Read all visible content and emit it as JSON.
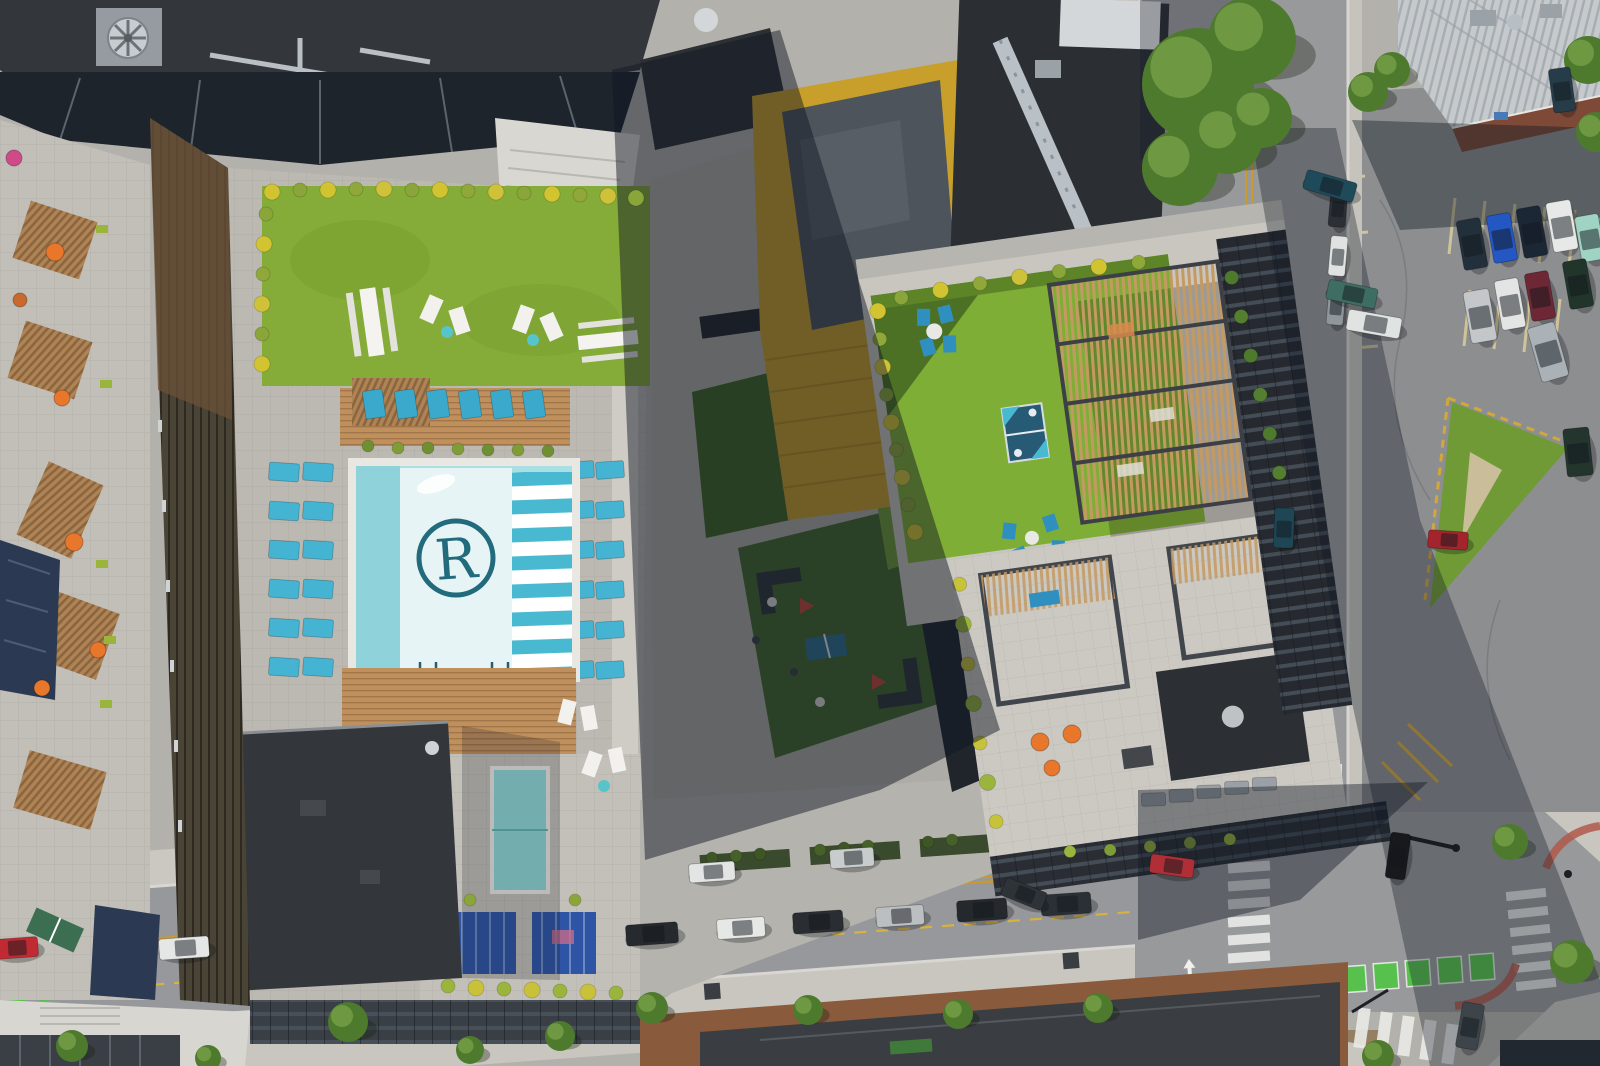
{
  "scene": {
    "description": "Aerial drone view of apartment rooftops with pool, lawns, pergola, streets, intersection and parking lot",
    "logo": {
      "letter": "R"
    },
    "palette": {
      "asphalt": "#98999b",
      "asphalt_dark": "#8d8e90",
      "concrete": "#c9c6bf",
      "deck_paver": "#bcb9b2",
      "lawn": "#85ab38",
      "lawn_shade": "#4c7124",
      "lawn_dark": "#44692b",
      "pool_water": "#aadfe4",
      "pool_edge": "#8fd2da",
      "pool_panel": "#e6f4f5",
      "pool_stripe": "#49b9d2",
      "logo_teal": "#216b7d",
      "lounger_teal": "#45b4d2",
      "wood": "#c0905c",
      "cabana_blue": "#2e55a5",
      "yellow_tower": "#c79f2a",
      "metal_roof": "#c6cacd",
      "brick": "#8a5a3c",
      "roof_dark": "#33373c",
      "facade_dark": "#2a2f36",
      "road_yellow": "#c99a2e",
      "road_green": "#58c14e",
      "curb_red": "#b0584a",
      "orange": "#e8762b",
      "tree_green": "#4e7a2e",
      "hot_tub": "#8fd8d4"
    },
    "cars": [
      [
        652,
        934,
        52,
        21,
        -4,
        "#26292d"
      ],
      [
        741,
        928,
        48,
        20,
        -4,
        "#e6e8e6"
      ],
      [
        818,
        922,
        50,
        21,
        -4,
        "#2a2d31"
      ],
      [
        900,
        916,
        48,
        20,
        -4,
        "#bcbfc2"
      ],
      [
        982,
        910,
        50,
        21,
        -4,
        "#25282c"
      ],
      [
        1066,
        904,
        50,
        21,
        -4,
        "#2b3036"
      ],
      [
        712,
        872,
        46,
        19,
        -4,
        "#e2e5e4"
      ],
      [
        852,
        858,
        44,
        19,
        -4,
        "#c9cccd"
      ],
      [
        1024,
        894,
        44,
        19,
        22,
        "#2e3338"
      ],
      [
        1172,
        866,
        44,
        19,
        8,
        "#b02f36"
      ],
      [
        16,
        948,
        44,
        20,
        -4,
        "#c22a33"
      ],
      [
        184,
        948,
        50,
        21,
        -4,
        "#e4e7e6"
      ],
      [
        1398,
        856,
        20,
        46,
        8,
        "#17191d"
      ],
      [
        1470,
        1026,
        22,
        46,
        10,
        "#3d454b"
      ],
      [
        1338,
        208,
        17,
        38,
        5,
        "#2c3036"
      ],
      [
        1338,
        256,
        17,
        40,
        5,
        "#dfe2e0"
      ],
      [
        1336,
        306,
        17,
        38,
        5,
        "#90979c"
      ],
      [
        1330,
        186,
        52,
        20,
        16,
        "#1f4a5a"
      ],
      [
        1352,
        294,
        50,
        20,
        12,
        "#3e6e63"
      ],
      [
        1374,
        324,
        54,
        21,
        10,
        "#dfe3e2"
      ],
      [
        1472,
        244,
        24,
        50,
        -10,
        "#22303c"
      ],
      [
        1502,
        238,
        24,
        48,
        -10,
        "#2257c4"
      ],
      [
        1532,
        232,
        24,
        50,
        -10,
        "#1c2736"
      ],
      [
        1562,
        226,
        25,
        50,
        -10,
        "#e6e9e7"
      ],
      [
        1590,
        238,
        24,
        46,
        -10,
        "#9fd3c3"
      ],
      [
        1480,
        316,
        26,
        52,
        -10,
        "#c3c7c9"
      ],
      [
        1510,
        304,
        24,
        50,
        -10,
        "#e2e5e3"
      ],
      [
        1540,
        296,
        24,
        48,
        -10,
        "#6e2734"
      ],
      [
        1548,
        352,
        28,
        56,
        -16,
        "#aab2b8"
      ],
      [
        1578,
        284,
        24,
        48,
        -10,
        "#22352a"
      ],
      [
        1578,
        452,
        26,
        48,
        -6,
        "#23352c"
      ],
      [
        1448,
        540,
        40,
        18,
        4,
        "#a3242c"
      ],
      [
        1284,
        528,
        20,
        40,
        2,
        "#1e4654"
      ],
      [
        1562,
        90,
        22,
        44,
        -8,
        "#273c49"
      ]
    ],
    "trees": [
      [
        1198,
        84,
        56
      ],
      [
        1252,
        40,
        44
      ],
      [
        1180,
        168,
        38
      ],
      [
        1228,
        140,
        34
      ],
      [
        1262,
        118,
        30
      ],
      [
        1368,
        92,
        20
      ],
      [
        1392,
        70,
        18
      ],
      [
        1588,
        60,
        24
      ],
      [
        1596,
        132,
        20
      ],
      [
        348,
        1022,
        20
      ],
      [
        470,
        1050,
        14
      ],
      [
        560,
        1036,
        15
      ],
      [
        652,
        1008,
        16
      ],
      [
        808,
        1010,
        15
      ],
      [
        958,
        1014,
        15
      ],
      [
        1098,
        1008,
        15
      ],
      [
        1510,
        842,
        18
      ],
      [
        1572,
        962,
        22
      ],
      [
        1378,
        1056,
        16
      ],
      [
        72,
        1046,
        16
      ],
      [
        208,
        1058,
        13
      ]
    ],
    "lounger_groups": [
      {
        "layer": "loungers-left",
        "x": 374,
        "y": 404,
        "cols": 6,
        "rows": 1,
        "dx": 32,
        "dy": 0,
        "w": 20,
        "h": 28,
        "a": -8,
        "c": "#3aa9cc"
      },
      {
        "layer": "loungers-left",
        "x": 284,
        "y": 472,
        "cols": 2,
        "rows": 6,
        "dx": 34,
        "dy": 39,
        "w": 30,
        "h": 18,
        "a": 4,
        "c": "#45b4d2"
      },
      {
        "layer": "loungers-left",
        "x": 580,
        "y": 470,
        "cols": 2,
        "rows": 6,
        "dx": 30,
        "dy": 40,
        "w": 28,
        "h": 17,
        "a": -4,
        "c": "#45b4d2"
      },
      {
        "layer": "loungers-left",
        "x": 558,
        "y": 806,
        "cols": 1,
        "rows": 3,
        "dx": 0,
        "dy": 30,
        "w": 30,
        "h": 18,
        "a": 2,
        "c": "#45b4d2"
      },
      {
        "layer": "loungers-right",
        "x": 1100,
        "y": 806,
        "cols": 5,
        "rows": 1,
        "dx": 28,
        "dy": 0,
        "w": 24,
        "h": 13,
        "a": 6,
        "c": "#9aa0a5"
      }
    ],
    "shrub_groups": [
      {
        "layer": "shrubs-root",
        "items": [
          [
            272,
            192,
            8,
            "#d2c431"
          ],
          [
            300,
            190,
            7,
            "#8aa63a"
          ],
          [
            328,
            190,
            8,
            "#d2c431"
          ],
          [
            356,
            189,
            7,
            "#90a83a"
          ],
          [
            384,
            189,
            8,
            "#cfc23a"
          ],
          [
            412,
            190,
            7,
            "#8aa63a"
          ],
          [
            440,
            190,
            8,
            "#d2c431"
          ],
          [
            468,
            191,
            7,
            "#90a83a"
          ],
          [
            496,
            192,
            8,
            "#cfc23a"
          ],
          [
            524,
            193,
            7,
            "#8aa63a"
          ],
          [
            552,
            194,
            8,
            "#d2c431"
          ],
          [
            580,
            195,
            7,
            "#90a83a"
          ],
          [
            608,
            196,
            8,
            "#cfc23a"
          ],
          [
            636,
            198,
            8,
            "#8aa63a"
          ],
          [
            266,
            214,
            7,
            "#8aa63a"
          ],
          [
            264,
            244,
            8,
            "#d2c431"
          ],
          [
            263,
            274,
            7,
            "#90a83a"
          ],
          [
            262,
            304,
            8,
            "#cfc23a"
          ],
          [
            262,
            334,
            7,
            "#8aa63a"
          ],
          [
            262,
            364,
            8,
            "#d2c431"
          ],
          [
            368,
            446,
            6,
            "#6f8f33"
          ],
          [
            398,
            448,
            6,
            "#7f9c36"
          ],
          [
            428,
            448,
            6,
            "#6f8f33"
          ],
          [
            458,
            449,
            6,
            "#7f9c36"
          ],
          [
            488,
            450,
            6,
            "#6f8f33"
          ],
          [
            518,
            450,
            6,
            "#7f9c36"
          ],
          [
            548,
            451,
            6,
            "#6f8f33"
          ],
          [
            448,
            986,
            7,
            "#9ab43c"
          ],
          [
            476,
            988,
            8,
            "#c9c13a"
          ],
          [
            504,
            989,
            7,
            "#9ab43c"
          ],
          [
            532,
            990,
            8,
            "#c9c13a"
          ],
          [
            560,
            991,
            7,
            "#9ab43c"
          ],
          [
            588,
            992,
            8,
            "#c9c13a"
          ],
          [
            616,
            993,
            7,
            "#9ab43c"
          ],
          [
            712,
            858,
            6,
            "#3e5526"
          ],
          [
            736,
            856,
            6,
            "#46602a"
          ],
          [
            760,
            854,
            6,
            "#3e5526"
          ],
          [
            820,
            850,
            6,
            "#46602a"
          ],
          [
            844,
            848,
            6,
            "#3e5526"
          ],
          [
            868,
            846,
            6,
            "#46602a"
          ],
          [
            928,
            842,
            6,
            "#3e5526"
          ],
          [
            952,
            840,
            6,
            "#46602a"
          ],
          [
            470,
            900,
            6,
            "#8aa63a"
          ],
          [
            575,
            900,
            6,
            "#8aa63a"
          ]
        ]
      },
      {
        "layer": "shrubs-right",
        "items": [
          [
            895,
            284,
            8,
            "#d2c431"
          ],
          [
            893,
            312,
            7,
            "#90a83a"
          ],
          [
            892,
            340,
            8,
            "#cfc23a"
          ],
          [
            892,
            368,
            7,
            "#8aa63a"
          ],
          [
            893,
            396,
            8,
            "#d2c431"
          ],
          [
            894,
            424,
            7,
            "#90a83a"
          ],
          [
            896,
            452,
            8,
            "#cfc23a"
          ],
          [
            898,
            480,
            7,
            "#8aa63a"
          ],
          [
            901,
            508,
            8,
            "#d2c431"
          ],
          [
            920,
            274,
            7,
            "#8aa63a"
          ],
          [
            960,
            272,
            8,
            "#d2c431"
          ],
          [
            1000,
            271,
            7,
            "#90a83a"
          ],
          [
            1040,
            270,
            8,
            "#cfc23a"
          ],
          [
            1080,
            270,
            7,
            "#8aa63a"
          ],
          [
            1120,
            271,
            8,
            "#d2c431"
          ],
          [
            1160,
            272,
            7,
            "#90a83a"
          ],
          [
            938,
            566,
            7,
            "#c6c23a"
          ],
          [
            936,
            606,
            8,
            "#9ab43c"
          ],
          [
            935,
            646,
            7,
            "#c6c23a"
          ],
          [
            935,
            686,
            8,
            "#9ab43c"
          ],
          [
            936,
            726,
            7,
            "#c6c23a"
          ],
          [
            938,
            766,
            8,
            "#9ab43c"
          ],
          [
            941,
            806,
            7,
            "#c6c23a"
          ],
          [
            1010,
            846,
            6,
            "#9ab43c"
          ],
          [
            1050,
            850,
            6,
            "#7f9c36"
          ],
          [
            1090,
            852,
            6,
            "#9ab43c"
          ],
          [
            1130,
            854,
            6,
            "#7f9c36"
          ],
          [
            1170,
            856,
            6,
            "#9ab43c"
          ],
          [
            1250,
            300,
            7,
            "#4e7a2e"
          ],
          [
            1254,
            340,
            7,
            "#557f30"
          ],
          [
            1258,
            380,
            7,
            "#4e7a2e"
          ],
          [
            1262,
            420,
            7,
            "#557f30"
          ],
          [
            1266,
            460,
            7,
            "#4e7a2e"
          ],
          [
            1270,
            500,
            7,
            "#557f30"
          ]
        ]
      }
    ],
    "umbrellas": [
      [
        55,
        252,
        9,
        "#e8762b"
      ],
      [
        62,
        398,
        8,
        "#e8762b"
      ],
      [
        74,
        542,
        9,
        "#e8762b"
      ],
      [
        42,
        688,
        8,
        "#e8762b"
      ],
      [
        98,
        650,
        8,
        "#e8762b"
      ],
      [
        14,
        158,
        8,
        "#d04a8a"
      ],
      [
        20,
        300,
        7,
        "#c86a2e"
      ],
      [
        1040,
        742,
        9,
        "#e8762b"
      ],
      [
        1072,
        734,
        9,
        "#e8762b"
      ],
      [
        1052,
        768,
        8,
        "#e8762b"
      ]
    ]
  }
}
